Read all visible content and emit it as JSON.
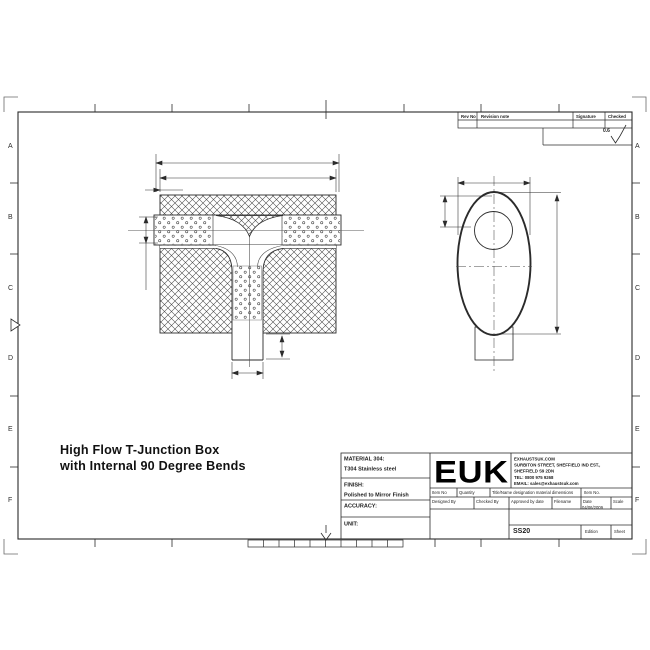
{
  "sheet": {
    "colors": {
      "line": "#2b2b2b",
      "background": "#ffffff"
    },
    "zone_letters": [
      "A",
      "B",
      "C",
      "D",
      "E",
      "F"
    ],
    "revision_table": {
      "col_rev_no": "Rev No",
      "col_revision_note": "Revision note",
      "col_signature": "Signature",
      "col_checked": "Checked"
    },
    "surface_finish_value": "0.6",
    "drawing_title_line1": "High Flow T-Junction Box",
    "drawing_title_line2": "with Internal 90 Degree Bends",
    "title_block": {
      "material_label": "MATERIAL 304:",
      "material_value": "T304 Stainless steel",
      "finish_label": "FINISH:",
      "finish_value": "Polished to Mirror Finish",
      "accuracy_label": "ACCURACY:",
      "unit_label": "UNIT:",
      "logo_text": "EUK",
      "company_line1": "EXHAUSTSUK.COM",
      "company_line2": "SURBITON STREET, SHEFFIELD IND EST.,",
      "company_line3": "SHEFFIELD S9 2DN",
      "company_line4": "TEL: 0800 975 9268",
      "company_line5": "EMAIL: sales@exhaustsuk.com",
      "parts_header_col1": "Item No",
      "parts_header_col2": "Quantity",
      "parts_header_col3": "Title/Name designation material dimensions",
      "parts_header_col4": "Item No.",
      "field_designed": "Designed By",
      "field_checked": "Checked By",
      "field_approved": "Approved by date",
      "field_filename": "Filename",
      "field_date": "Date",
      "field_scale": "Scale",
      "date_value": "04/06/2009",
      "drawing_number": "SS20",
      "edition_label": "Edition",
      "sheet_label": "Sheet"
    }
  }
}
